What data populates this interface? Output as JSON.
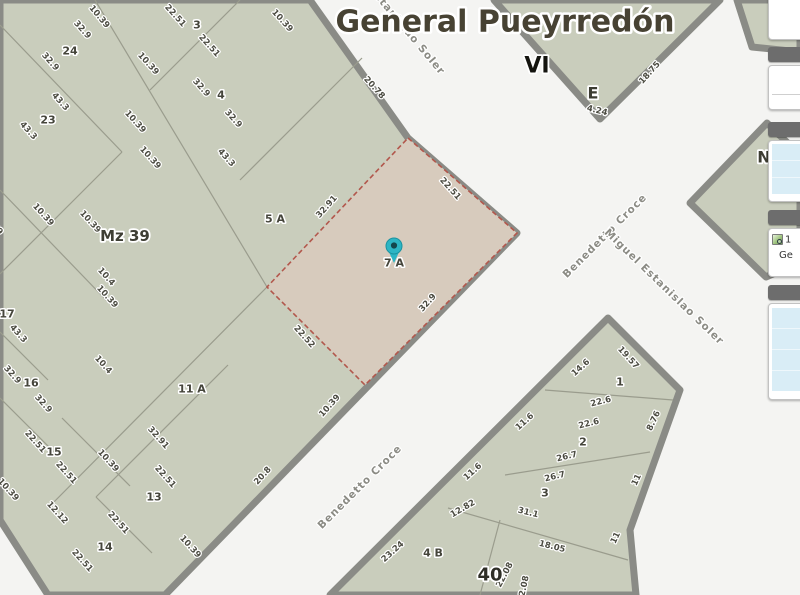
{
  "title": "General Pueyrredón",
  "colors": {
    "block_fill": "#c9cdbc",
    "road_casing": "#8a8b86",
    "street_bg": "#f4f4f2",
    "highlight_fill": "#d7cbbd",
    "highlight_border": "#b2574c",
    "marker": "#2db5c4",
    "panel_header": "#6d6d6d",
    "panel_row": "#d9edf6"
  },
  "marker": {
    "color": "#2db5c4",
    "on_parcel": "7 A"
  },
  "panel": {
    "result_line1": "1",
    "result_line2": "Ge"
  },
  "map": {
    "labels": [
      {
        "text": "10.39",
        "x": 99,
        "y": 17,
        "r": 50,
        "kind": "dim"
      },
      {
        "text": "32.9",
        "x": 82,
        "y": 30,
        "r": 48,
        "kind": "dim"
      },
      {
        "text": "22.51",
        "x": 175,
        "y": 16,
        "r": 48,
        "kind": "dim"
      },
      {
        "text": "10.39",
        "x": 282,
        "y": 21,
        "r": 48,
        "kind": "dim"
      },
      {
        "text": "22.51",
        "x": 209,
        "y": 46,
        "r": 48,
        "kind": "dim"
      },
      {
        "text": "32.9",
        "x": 50,
        "y": 62,
        "r": 48,
        "kind": "dim"
      },
      {
        "text": "10.39",
        "x": 148,
        "y": 64,
        "r": 48,
        "kind": "dim"
      },
      {
        "text": "32.9",
        "x": 201,
        "y": 88,
        "r": 48,
        "kind": "dim"
      },
      {
        "text": "43.3",
        "x": 60,
        "y": 102,
        "r": 48,
        "kind": "dim"
      },
      {
        "text": "32.9",
        "x": 233,
        "y": 119,
        "r": 48,
        "kind": "dim"
      },
      {
        "text": "10.39",
        "x": 135,
        "y": 122,
        "r": 48,
        "kind": "dim"
      },
      {
        "text": "43.3",
        "x": 28,
        "y": 131,
        "r": 48,
        "kind": "dim"
      },
      {
        "text": "10.39",
        "x": 150,
        "y": 158,
        "r": 48,
        "kind": "dim"
      },
      {
        "text": "43.3",
        "x": 226,
        "y": 158,
        "r": 48,
        "kind": "dim"
      },
      {
        "text": "20.78",
        "x": 374,
        "y": 88,
        "r": 48,
        "kind": "dim"
      },
      {
        "text": "18.75",
        "x": 650,
        "y": 73,
        "r": -48,
        "kind": "dim"
      },
      {
        "text": "4.24",
        "x": 597,
        "y": 111,
        "r": 14,
        "kind": "dim"
      },
      {
        "text": "10.39",
        "x": 43,
        "y": 215,
        "r": 48,
        "kind": "dim"
      },
      {
        "text": "10.39",
        "x": -8,
        "y": 224,
        "r": 48,
        "kind": "dim"
      },
      {
        "text": "10.39",
        "x": 90,
        "y": 222,
        "r": 48,
        "kind": "dim"
      },
      {
        "text": "10.4",
        "x": 106,
        "y": 277,
        "r": 48,
        "kind": "dim"
      },
      {
        "text": "10.39",
        "x": 107,
        "y": 297,
        "r": 48,
        "kind": "dim"
      },
      {
        "text": "43.3",
        "x": 18,
        "y": 334,
        "r": 48,
        "kind": "dim"
      },
      {
        "text": "32.91",
        "x": 327,
        "y": 207,
        "r": -48,
        "kind": "dim"
      },
      {
        "text": "22.51",
        "x": 450,
        "y": 189,
        "r": 48,
        "kind": "dim"
      },
      {
        "text": "22.52",
        "x": 304,
        "y": 337,
        "r": 48,
        "kind": "dim"
      },
      {
        "text": "32.9",
        "x": 428,
        "y": 303,
        "r": -48,
        "kind": "dim"
      },
      {
        "text": "10.4",
        "x": 103,
        "y": 365,
        "r": 48,
        "kind": "dim"
      },
      {
        "text": "32.9",
        "x": 12,
        "y": 375,
        "r": 48,
        "kind": "dim"
      },
      {
        "text": "32.9",
        "x": 43,
        "y": 404,
        "r": 48,
        "kind": "dim"
      },
      {
        "text": "10.39",
        "x": 330,
        "y": 406,
        "r": -48,
        "kind": "dim"
      },
      {
        "text": "20.8",
        "x": 263,
        "y": 476,
        "r": -48,
        "kind": "dim"
      },
      {
        "text": "22.51",
        "x": 35,
        "y": 442,
        "r": 48,
        "kind": "dim"
      },
      {
        "text": "22.51",
        "x": 66,
        "y": 473,
        "r": 48,
        "kind": "dim"
      },
      {
        "text": "10.39",
        "x": 8,
        "y": 490,
        "r": 48,
        "kind": "dim"
      },
      {
        "text": "32.91",
        "x": 158,
        "y": 438,
        "r": 48,
        "kind": "dim"
      },
      {
        "text": "10.39",
        "x": 108,
        "y": 461,
        "r": 48,
        "kind": "dim"
      },
      {
        "text": "22.51",
        "x": 165,
        "y": 477,
        "r": 48,
        "kind": "dim"
      },
      {
        "text": "12.12",
        "x": 57,
        "y": 513,
        "r": 48,
        "kind": "dim"
      },
      {
        "text": "22.51",
        "x": 118,
        "y": 523,
        "r": 48,
        "kind": "dim"
      },
      {
        "text": "22.51",
        "x": 82,
        "y": 561,
        "r": 48,
        "kind": "dim"
      },
      {
        "text": "10.39",
        "x": 190,
        "y": 547,
        "r": 48,
        "kind": "dim"
      },
      {
        "text": "19.57",
        "x": 628,
        "y": 358,
        "r": 48,
        "kind": "dim"
      },
      {
        "text": "14.6",
        "x": 581,
        "y": 368,
        "r": -42,
        "kind": "dim"
      },
      {
        "text": "22.6",
        "x": 601,
        "y": 402,
        "r": -14,
        "kind": "dim"
      },
      {
        "text": "22.6",
        "x": 589,
        "y": 424,
        "r": -14,
        "kind": "dim"
      },
      {
        "text": "8.76",
        "x": 654,
        "y": 421,
        "r": -65,
        "kind": "dim"
      },
      {
        "text": "26.7",
        "x": 567,
        "y": 457,
        "r": -14,
        "kind": "dim"
      },
      {
        "text": "26.7",
        "x": 555,
        "y": 477,
        "r": -14,
        "kind": "dim"
      },
      {
        "text": "11",
        "x": 637,
        "y": 480,
        "r": -65,
        "kind": "dim"
      },
      {
        "text": "11.6",
        "x": 525,
        "y": 422,
        "r": -42,
        "kind": "dim"
      },
      {
        "text": "11.6",
        "x": 473,
        "y": 472,
        "r": -42,
        "kind": "dim"
      },
      {
        "text": "31.1",
        "x": 528,
        "y": 513,
        "r": 14,
        "kind": "dim"
      },
      {
        "text": "12.82",
        "x": 463,
        "y": 509,
        "r": -30,
        "kind": "dim"
      },
      {
        "text": "18.05",
        "x": 552,
        "y": 547,
        "r": 14,
        "kind": "dim"
      },
      {
        "text": "11",
        "x": 616,
        "y": 538,
        "r": -65,
        "kind": "dim"
      },
      {
        "text": "23.24",
        "x": 393,
        "y": 552,
        "r": -42,
        "kind": "dim"
      },
      {
        "text": "22.08",
        "x": 505,
        "y": 575,
        "r": -62,
        "kind": "dim"
      },
      {
        "text": "22.08",
        "x": 524,
        "y": 589,
        "r": -78,
        "kind": "dim"
      },
      {
        "text": "24",
        "x": 70,
        "y": 51,
        "r": 0,
        "kind": "parcel"
      },
      {
        "text": "3",
        "x": 197,
        "y": 25,
        "r": 0,
        "kind": "parcel"
      },
      {
        "text": "23",
        "x": 48,
        "y": 120,
        "r": 0,
        "kind": "parcel"
      },
      {
        "text": "4",
        "x": 221,
        "y": 95,
        "r": 0,
        "kind": "parcel"
      },
      {
        "text": "17",
        "x": 7,
        "y": 314,
        "r": 0,
        "kind": "parcel"
      },
      {
        "text": "16",
        "x": 31,
        "y": 383,
        "r": 0,
        "kind": "parcel"
      },
      {
        "text": "15",
        "x": 54,
        "y": 452,
        "r": 0,
        "kind": "parcel"
      },
      {
        "text": "13",
        "x": 154,
        "y": 497,
        "r": 0,
        "kind": "parcel"
      },
      {
        "text": "14",
        "x": 105,
        "y": 547,
        "r": 0,
        "kind": "parcel"
      },
      {
        "text": "5 A",
        "x": 275,
        "y": 219,
        "r": 0,
        "kind": "parcel"
      },
      {
        "text": "7 A",
        "x": 394,
        "y": 263,
        "r": 0,
        "kind": "parcel"
      },
      {
        "text": "11 A",
        "x": 192,
        "y": 389,
        "r": 0,
        "kind": "parcel"
      },
      {
        "text": "1",
        "x": 620,
        "y": 382,
        "r": 0,
        "kind": "parcel"
      },
      {
        "text": "2",
        "x": 583,
        "y": 442,
        "r": 0,
        "kind": "parcel"
      },
      {
        "text": "3",
        "x": 545,
        "y": 493,
        "r": 0,
        "kind": "parcel"
      },
      {
        "text": "4 B",
        "x": 433,
        "y": 553,
        "r": 0,
        "kind": "parcel"
      },
      {
        "text": "Mz 39",
        "x": 125,
        "y": 236,
        "r": 0,
        "kind": "block"
      },
      {
        "text": "40",
        "x": 490,
        "y": 575,
        "r": 0,
        "kind": "big"
      },
      {
        "text": "VI",
        "x": 537,
        "y": 66,
        "r": 0,
        "kind": "zonebig"
      },
      {
        "text": "E",
        "x": 593,
        "y": 93,
        "r": 0,
        "kind": "zone"
      },
      {
        "text": "N",
        "x": 764,
        "y": 157,
        "r": 0,
        "kind": "zone"
      },
      {
        "text": "Estanislao Soler",
        "x": 407,
        "y": 31,
        "r": 50,
        "kind": "street"
      },
      {
        "text": "Benedetto Croce",
        "x": 605,
        "y": 236,
        "r": -45,
        "kind": "street"
      },
      {
        "text": "Miguel Estanislao Soler",
        "x": 664,
        "y": 287,
        "r": 44,
        "kind": "street"
      },
      {
        "text": "Benedetto Croce",
        "x": 360,
        "y": 487,
        "r": -45,
        "kind": "street"
      }
    ]
  }
}
